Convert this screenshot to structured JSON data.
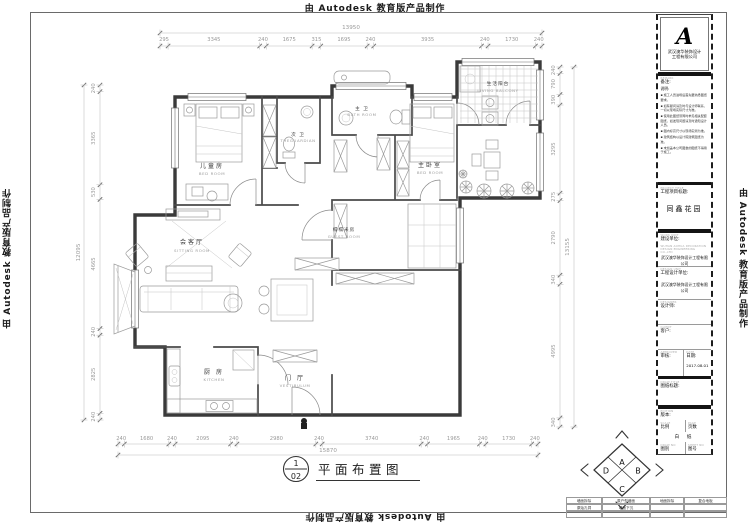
{
  "autodesk": "由 Autodesk 教育版产品制作",
  "rooms": [
    {
      "zh": "儿童房",
      "en": "BED  ROOM"
    },
    {
      "zh": "次 卫",
      "en": "THEGUARDIAN"
    },
    {
      "zh": "主 卫",
      "en": "BATH  ROOM"
    },
    {
      "zh": "主卧室",
      "en": "BED  ROOM"
    },
    {
      "zh": "生活阳台",
      "en": "LIVING  BALCONY"
    },
    {
      "zh": "榻榻米房",
      "en": "GUEST  ROOM"
    },
    {
      "zh": "会客厅",
      "en": "SITTING  ROOM"
    },
    {
      "zh": "厨 房",
      "en": "KITCHEN"
    },
    {
      "zh": "门 厅",
      "en": "VESTIBULUM"
    }
  ],
  "dimensions": {
    "top": {
      "total": "13950",
      "segments": [
        295,
        3345,
        240,
        1675,
        315,
        1695,
        240,
        3935,
        240,
        1730,
        240
      ]
    },
    "bottom": {
      "total": "15870",
      "segments": [
        240,
        1680,
        240,
        2095,
        240,
        2980,
        240,
        3740,
        240,
        1965,
        240,
        1730,
        240
      ]
    },
    "left": {
      "total": "12095",
      "segments": [
        240,
        3365,
        530,
        4665,
        240,
        2825,
        240
      ]
    },
    "right": {
      "total": "13155",
      "segments": [
        240,
        790,
        390,
        3295,
        275,
        2790,
        340,
        4995,
        340
      ]
    }
  },
  "drawing_label": {
    "num": "1",
    "sheet": "02",
    "title": "平面布置图"
  },
  "compass": {
    "top": "A",
    "right": "B",
    "bottom": "C",
    "left": "D"
  },
  "title_block": {
    "logo_glyph": "A",
    "company_line1": "武汉澳华装饰设计",
    "company_line2": "工程有限公司",
    "notes_en": "REMARK",
    "notes_label": "备注:",
    "notes_sub": "说明:",
    "notes": [
      "施工人员进场后首先要熟悉图纸要求。",
      "如有疑问请及时与设计师联系，一切以现场实际尺寸为准。",
      "使用此图纸须同时参见相关配套图纸，如发现问题请及时通知设计人员。",
      "图内标高尺寸以现场实测为准。",
      "建筑结构以设计院建筑图纸为准。",
      "未加盖本公司图章的图纸不得用于施工。"
    ],
    "project_en": "PROJECT TITLE",
    "project_label": "工程项目标题:",
    "project_value": "同鑫花园",
    "build_en": "WORK UNIT",
    "build_label": "建设单位:",
    "build_sub_en": "WUHAN AOHUA DECORATION DESIGN ENGINEERING CO.,LTD",
    "build_value": "武汉澳华装饰设计工程有限公司",
    "design_en": "DESIGN UNIT",
    "design_label": "工程设计单位:",
    "design_value": "武汉澳华装饰设计工程有限公司",
    "designer_en": "DESIGNER",
    "designer_label": "设计师:",
    "client_en": "CLIENT",
    "client_label": "客户:",
    "check_en": "APPROVED",
    "check_label": "审核:",
    "date_en": "DATE",
    "date_label": "日期:",
    "date_value": "2017.08.01",
    "sheet_title_en": "DRAW TITLE",
    "sheet_title_label": "图纸标题:",
    "version_en": "EDITION",
    "version_label": "版本:",
    "scale_en": "SCALE",
    "scale_label": "比例",
    "pages_en": "PAGE",
    "pages_label": "页数",
    "paper_value": "白 纸",
    "cat_en": "DRAW NO",
    "cat_label": "图别",
    "no_en": "SHEET NO",
    "no_label": "图号"
  },
  "legend": {
    "rows": [
      [
        "墙面拆除",
        "原户型墙面",
        "地面拆除",
        "复合地板"
      ],
      [
        "原始孔洞",
        "墙面下沉",
        "",
        ""
      ]
    ]
  }
}
